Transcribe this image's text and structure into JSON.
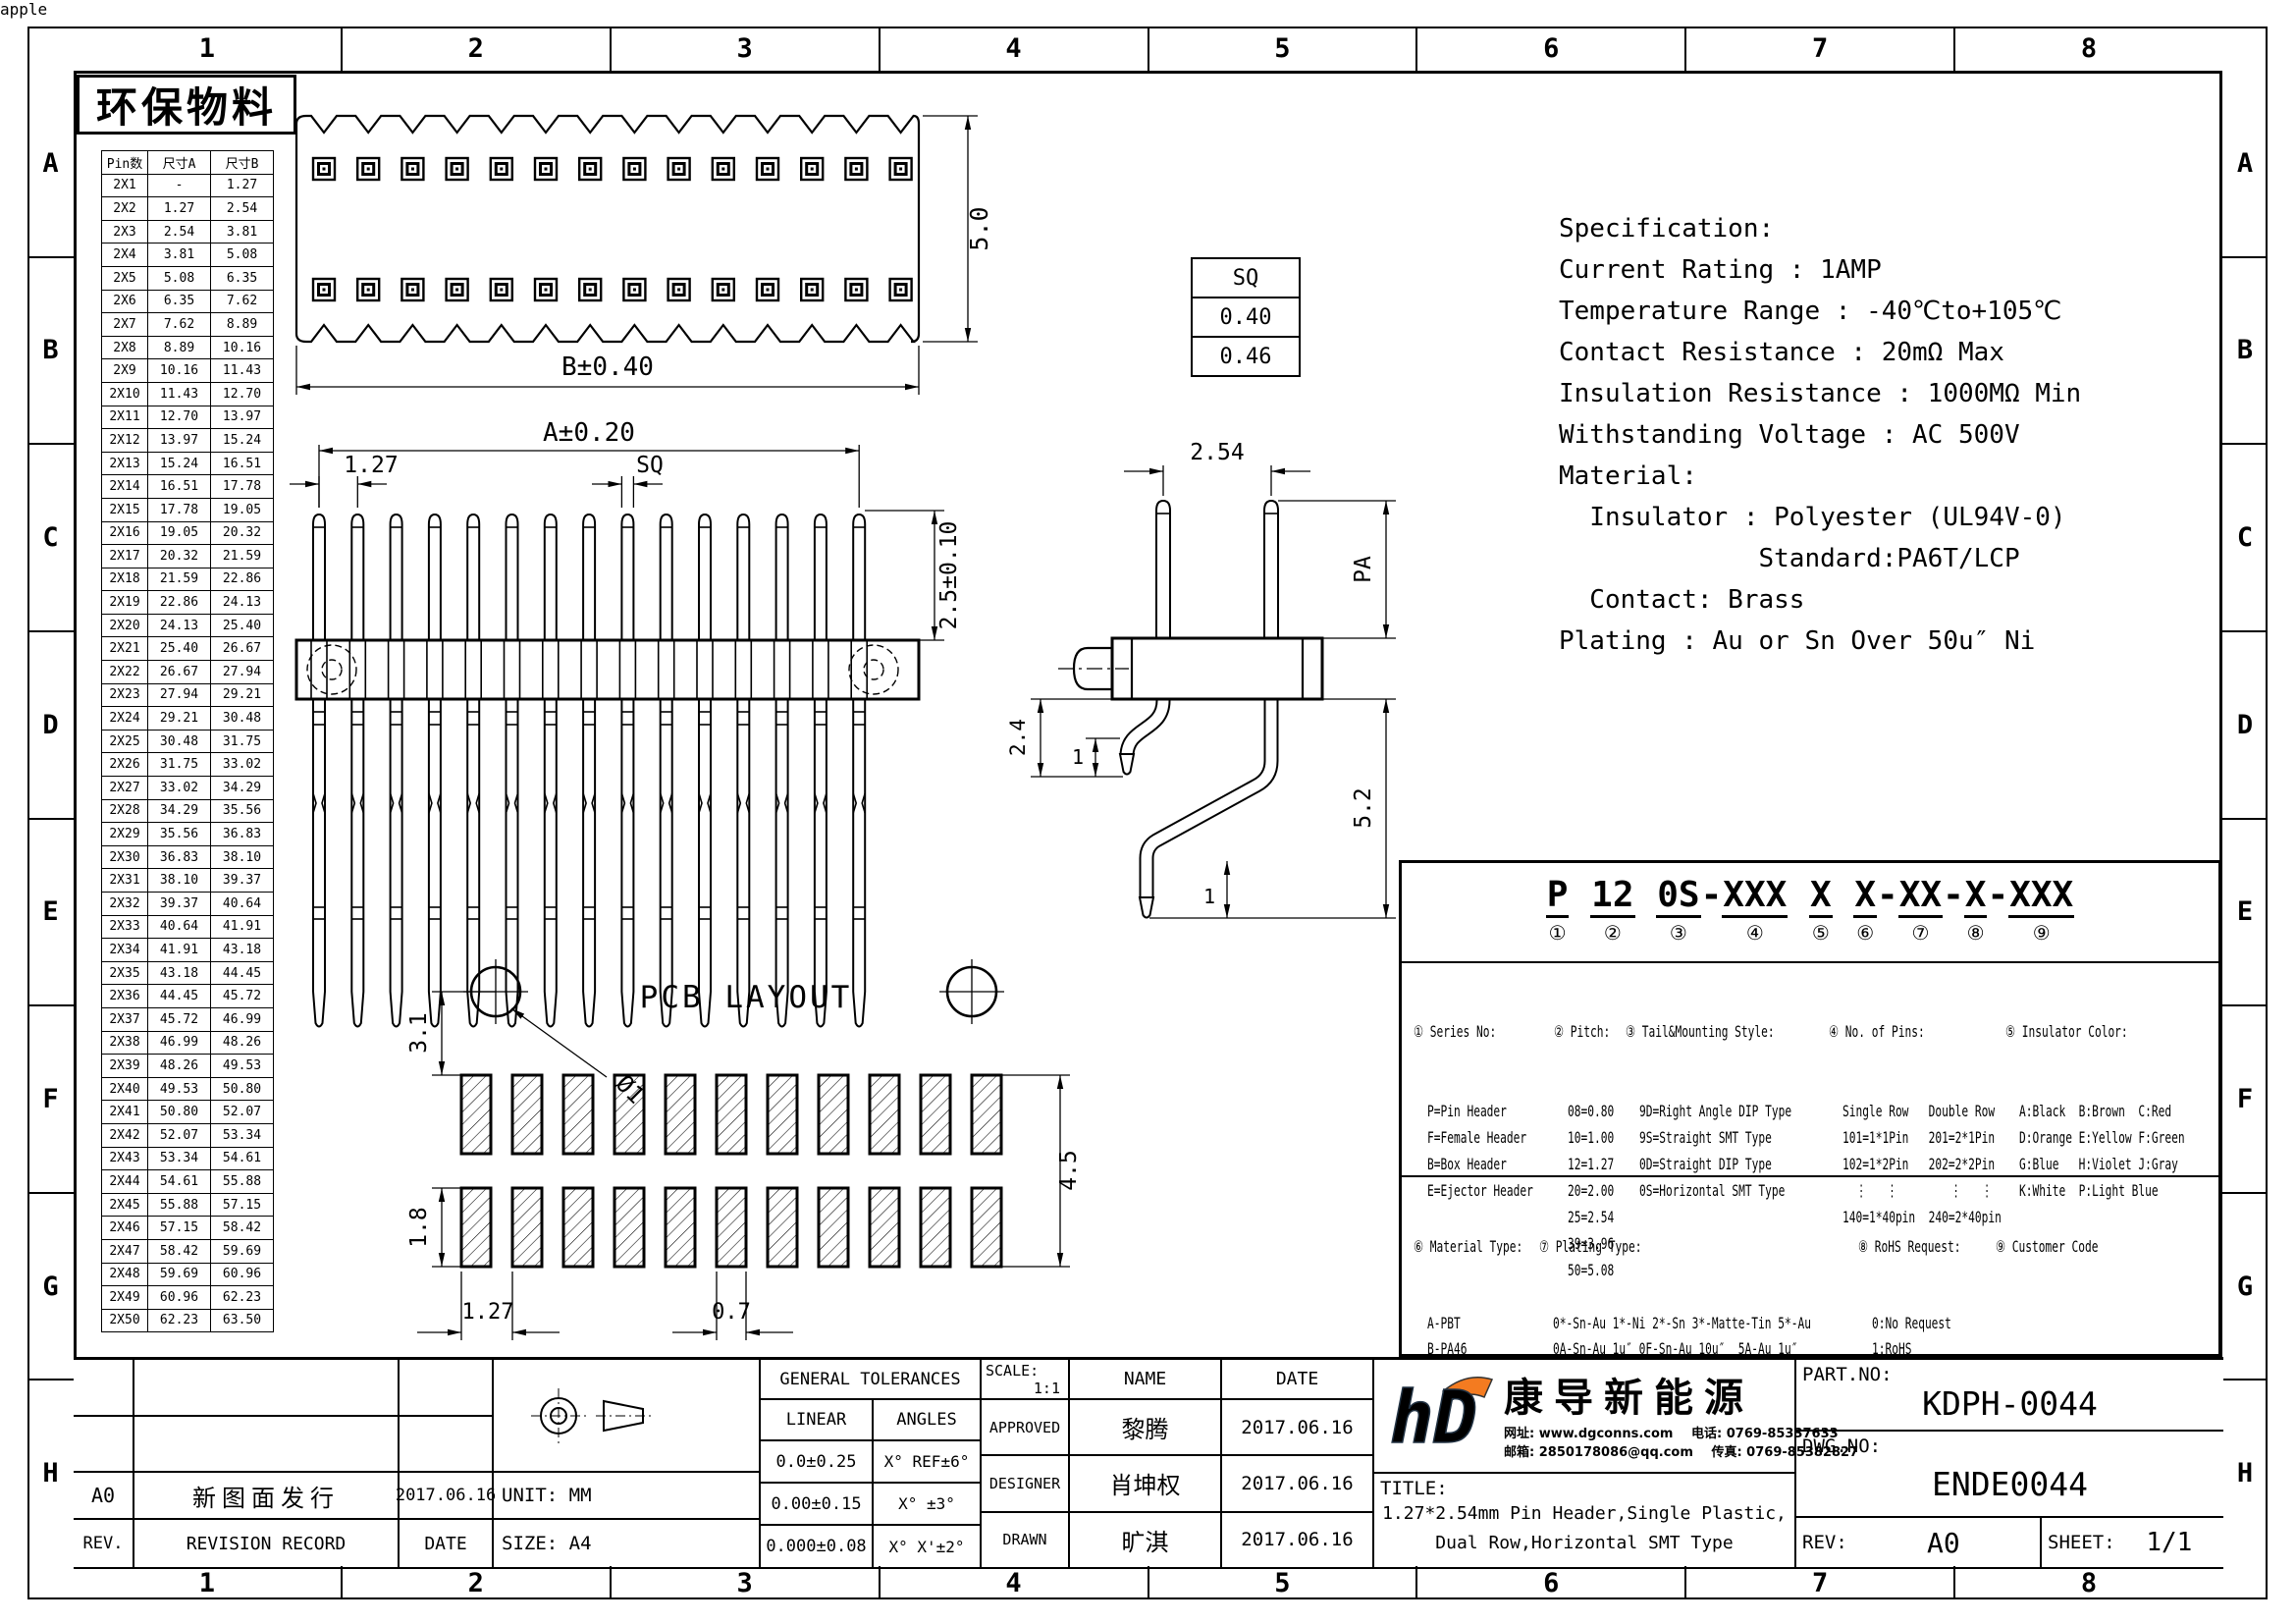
{
  "frame": {
    "cols": [
      "1",
      "2",
      "3",
      "4",
      "5",
      "6",
      "7",
      "8"
    ],
    "rows": [
      "A",
      "B",
      "C",
      "D",
      "E",
      "F",
      "G",
      "H"
    ]
  },
  "stamp": "环保物料",
  "pin_table": {
    "headers": [
      "Pin数",
      "尺寸A",
      "尺寸B"
    ],
    "rows": [
      {
        "p": "2X1",
        "a": "-",
        "b": "1.27"
      },
      {
        "p": "2X2",
        "a": "1.27",
        "b": "2.54"
      },
      {
        "p": "2X3",
        "a": "2.54",
        "b": "3.81"
      },
      {
        "p": "2X4",
        "a": "3.81",
        "b": "5.08"
      },
      {
        "p": "2X5",
        "a": "5.08",
        "b": "6.35"
      },
      {
        "p": "2X6",
        "a": "6.35",
        "b": "7.62"
      },
      {
        "p": "2X7",
        "a": "7.62",
        "b": "8.89"
      },
      {
        "p": "2X8",
        "a": "8.89",
        "b": "10.16"
      },
      {
        "p": "2X9",
        "a": "10.16",
        "b": "11.43"
      },
      {
        "p": "2X10",
        "a": "11.43",
        "b": "12.70"
      },
      {
        "p": "2X11",
        "a": "12.70",
        "b": "13.97"
      },
      {
        "p": "2X12",
        "a": "13.97",
        "b": "15.24"
      },
      {
        "p": "2X13",
        "a": "15.24",
        "b": "16.51"
      },
      {
        "p": "2X14",
        "a": "16.51",
        "b": "17.78"
      },
      {
        "p": "2X15",
        "a": "17.78",
        "b": "19.05"
      },
      {
        "p": "2X16",
        "a": "19.05",
        "b": "20.32"
      },
      {
        "p": "2X17",
        "a": "20.32",
        "b": "21.59"
      },
      {
        "p": "2X18",
        "a": "21.59",
        "b": "22.86"
      },
      {
        "p": "2X19",
        "a": "22.86",
        "b": "24.13"
      },
      {
        "p": "2X20",
        "a": "24.13",
        "b": "25.40"
      },
      {
        "p": "2X21",
        "a": "25.40",
        "b": "26.67"
      },
      {
        "p": "2X22",
        "a": "26.67",
        "b": "27.94"
      },
      {
        "p": "2X23",
        "a": "27.94",
        "b": "29.21"
      },
      {
        "p": "2X24",
        "a": "29.21",
        "b": "30.48"
      },
      {
        "p": "2X25",
        "a": "30.48",
        "b": "31.75"
      },
      {
        "p": "2X26",
        "a": "31.75",
        "b": "33.02"
      },
      {
        "p": "2X27",
        "a": "33.02",
        "b": "34.29"
      },
      {
        "p": "2X28",
        "a": "34.29",
        "b": "35.56"
      },
      {
        "p": "2X29",
        "a": "35.56",
        "b": "36.83"
      },
      {
        "p": "2X30",
        "a": "36.83",
        "b": "38.10"
      },
      {
        "p": "2X31",
        "a": "38.10",
        "b": "39.37"
      },
      {
        "p": "2X32",
        "a": "39.37",
        "b": "40.64"
      },
      {
        "p": "2X33",
        "a": "40.64",
        "b": "41.91"
      },
      {
        "p": "2X34",
        "a": "41.91",
        "b": "43.18"
      },
      {
        "p": "2X35",
        "a": "43.18",
        "b": "44.45"
      },
      {
        "p": "2X36",
        "a": "44.45",
        "b": "45.72"
      },
      {
        "p": "2X37",
        "a": "45.72",
        "b": "46.99"
      },
      {
        "p": "2X38",
        "a": "46.99",
        "b": "48.26"
      },
      {
        "p": "2X39",
        "a": "48.26",
        "b": "49.53"
      },
      {
        "p": "2X40",
        "a": "49.53",
        "b": "50.80"
      },
      {
        "p": "2X41",
        "a": "50.80",
        "b": "52.07"
      },
      {
        "p": "2X42",
        "a": "52.07",
        "b": "53.34"
      },
      {
        "p": "2X43",
        "a": "53.34",
        "b": "54.61"
      },
      {
        "p": "2X44",
        "a": "54.61",
        "b": "55.88"
      },
      {
        "p": "2X45",
        "a": "55.88",
        "b": "57.15"
      },
      {
        "p": "2X46",
        "a": "57.15",
        "b": "58.42"
      },
      {
        "p": "2X47",
        "a": "58.42",
        "b": "59.69"
      },
      {
        "p": "2X48",
        "a": "59.69",
        "b": "60.96"
      },
      {
        "p": "2X49",
        "a": "60.96",
        "b": "62.23"
      },
      {
        "p": "2X50",
        "a": "62.23",
        "b": "63.50"
      }
    ]
  },
  "sq_table": {
    "header": "SQ",
    "v1": "0.40",
    "v2": "0.46"
  },
  "dims": {
    "top_height": "5.0",
    "top_width": "B±0.40",
    "fv_width": "A±0.20",
    "fv_pitch": "1.27",
    "fv_sq": "SQ",
    "fv_pin": "2.5±0.10",
    "sv_pitch": "2.54",
    "sv_pa": "PA",
    "sv_24": "2.4",
    "sv_1a": "1",
    "sv_52": "5.2",
    "sv_1b": "1",
    "pcb_title": "PCB LAYOUT",
    "pcb_hole": "Ø1",
    "pcb_31": "3.1",
    "pcb_18": "1.8",
    "pcb_127": "1.27",
    "pcb_07": "0.7",
    "pcb_45": "4.5"
  },
  "spec": {
    "lines": [
      {
        "t": "Specification:"
      },
      {
        "t": "Current Rating : 1AMP"
      },
      {
        "t": "Temperature Range : -40℃to+105℃"
      },
      {
        "t": "Contact Resistance : 20mΩ Max"
      },
      {
        "t": "Insulation Resistance : 1000MΩ Min"
      },
      {
        "t": "Withstanding Voltage : AC 500V"
      },
      {
        "t": "Material:"
      },
      {
        "t": "  Insulator : Polyester (UL94V-0)"
      },
      {
        "t": "             Standard:PA6T/LCP"
      },
      {
        "t": "  Contact: Brass"
      },
      {
        "t": "Plating : Au or Sn Over 50u″ Ni"
      }
    ]
  },
  "ordering": {
    "code_parts": [
      {
        "pre": "",
        "seg": "P",
        "num": "①"
      },
      {
        "pre": " ",
        "seg": "12",
        "num": "②"
      },
      {
        "pre": " ",
        "seg": "0S",
        "num": "③"
      },
      {
        "pre": "-",
        "seg": "XXX",
        "num": "④"
      },
      {
        "pre": " ",
        "seg": "X",
        "num": "⑤"
      },
      {
        "pre": " ",
        "seg": "X",
        "num": "⑥"
      },
      {
        "pre": "-",
        "seg": "XX",
        "num": "⑦"
      },
      {
        "pre": "-",
        "seg": "X",
        "num": "⑧"
      },
      {
        "pre": "-",
        "seg": "XXX",
        "num": "⑨"
      }
    ],
    "s1": {
      "h": "① Series No:",
      "lines": [
        {
          "t": "P=Pin Header"
        },
        {
          "t": "F=Female Header"
        },
        {
          "t": "B=Box Header"
        },
        {
          "t": "E=Ejector Header"
        }
      ]
    },
    "s2": {
      "h": "② Pitch:",
      "lines": [
        {
          "t": "08=0.80"
        },
        {
          "t": "10=1.00"
        },
        {
          "t": "12=1.27"
        },
        {
          "t": "20=2.00"
        },
        {
          "t": "25=2.54"
        },
        {
          "t": "39=3.96"
        },
        {
          "t": "50=5.08"
        }
      ]
    },
    "s3": {
      "h": "③ Tail&Mounting Style:",
      "lines": [
        {
          "t": "9D=Right Angle DIP Type"
        },
        {
          "t": "9S=Straight SMT Type"
        },
        {
          "t": "0D=Straight DIP Type"
        },
        {
          "t": "0S=Horizontal SMT Type"
        }
      ]
    },
    "s4": {
      "h": "④ No. of Pins:",
      "lines": [
        {
          "t": "Single Row   Double Row"
        },
        {
          "t": "101=1*1Pin   201=2*1Pin"
        },
        {
          "t": "102=1*2Pin   202=2*2Pin"
        },
        {
          "t": "  ⋮   ⋮        ⋮   ⋮"
        },
        {
          "t": "140=1*40pin  240=2*40pin"
        }
      ]
    },
    "s5": {
      "h": "⑤ Insulator Color:",
      "lines": [
        {
          "t": "A:Black  B:Brown  C:Red"
        },
        {
          "t": "D:Orange E:Yellow F:Green"
        },
        {
          "t": "G:Blue   H:Violet J:Gray"
        },
        {
          "t": "K:White  P:Light Blue"
        }
      ]
    },
    "s6": {
      "h": "⑥ Material Type:",
      "lines": [
        {
          "t": "A-PBT"
        },
        {
          "t": "B-PA46"
        },
        {
          "t": "C-PA6T"
        },
        {
          "t": "D-PA9T"
        },
        {
          "t": "E-LCP"
        }
      ]
    },
    "s7": {
      "h": "⑦ Plating Type:",
      "lines": [
        {
          "t": "0*-Sn-Au 1*-Ni 2*-Sn 3*-Matte-Tin 5*-Au"
        },
        {
          "t": "0A-Sn-Au 1u″ 0F-Sn-Au 10u″  5A-Au 1u″"
        },
        {
          "t": "0B-Sn-Au 2u″ 0G-Sn-Au 15u″  5B-Au 2u″"
        },
        {
          "t": "0C-Sn-Au 3u″ 0H-Sn-Au 30u″  5C-Au 3u″"
        },
        {
          "t": "0D-Sn-Au 4u″ 0I-Sn-Au 40u″      ⋮"
        },
        {
          "t": "0E-Sn-Au 5u″ 0J-Sn-Au 50u″  5J-Au 50u″"
        }
      ]
    },
    "s8": {
      "h": "⑧ RoHS Request:",
      "lines": [
        {
          "t": "0:No Request"
        },
        {
          "t": "1:RoHS"
        },
        {
          "t": "2:HF(Halogen Free)"
        }
      ]
    },
    "s9": {
      "h": "⑨ Customer Code",
      "lines": []
    }
  },
  "titleblock": {
    "rev_row": {
      "rev": "A0",
      "record": "新图面发行",
      "date": "2017.06.16"
    },
    "rev_header": {
      "rev": "REV.",
      "record": "REVISION RECORD",
      "date": "DATE"
    },
    "unit": "UNIT: MM",
    "size": "SIZE: A4",
    "tol": {
      "title": "GENERAL TOLERANCES",
      "linear": "LINEAR",
      "angles": "ANGLES",
      "rows": [
        {
          "l": "0.0±0.25",
          "a": "X° REF±6°"
        },
        {
          "l": "0.00±0.15",
          "a": "X° ±3°"
        },
        {
          "l": "0.000±0.08",
          "a": "X° X'±2°"
        }
      ]
    },
    "scale_label": "SCALE:",
    "scale": "1:1",
    "name_h": "NAME",
    "date_h": "DATE",
    "approvals": [
      {
        "role": "APPROVED",
        "name": "黎腾",
        "date": "2017.06.16"
      },
      {
        "role": "DESIGNER",
        "name": "肖坤权",
        "date": "2017.06.16"
      },
      {
        "role": "DRAWN",
        "name": "旷淇",
        "date": "2017.06.16"
      }
    ],
    "company": {
      "name": "康导新能源",
      "c1": "网址: www.dgconns.com",
      "c2": "电话: 0769-85337633",
      "c3": "邮箱: 2850178086@qq.com",
      "c4": "传真: 0769-85382827"
    },
    "title_label": "TITLE:",
    "title1": "1.27*2.54mm Pin Header,Single Plastic,",
    "title2": "Dual Row,Horizontal SMT Type",
    "part_label": "PART.NO:",
    "part": "KDPH-0044",
    "dwg_label": "DWG.NO:",
    "dwg": "ENDE0044",
    "rev_label": "REV:",
    "rev": "A0",
    "sheet_label": "SHEET:",
    "sheet": "1/1"
  }
}
